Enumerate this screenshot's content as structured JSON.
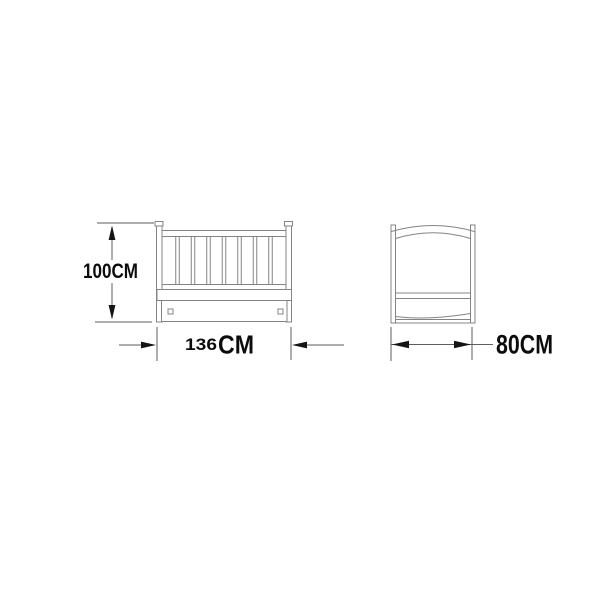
{
  "diagram": {
    "type": "furniture-dimension-drawing",
    "subject": "baby crib shown in front view and side view with measurements",
    "background": "#ffffff",
    "line_color": "#848484",
    "dimension_line_color": "#5e5e5e",
    "text_color": "#0c0c0c",
    "front_view": {
      "height_label": "100CM",
      "width_value": "136",
      "width_unit": "CM"
    },
    "side_view": {
      "width_label": "80CM"
    }
  }
}
